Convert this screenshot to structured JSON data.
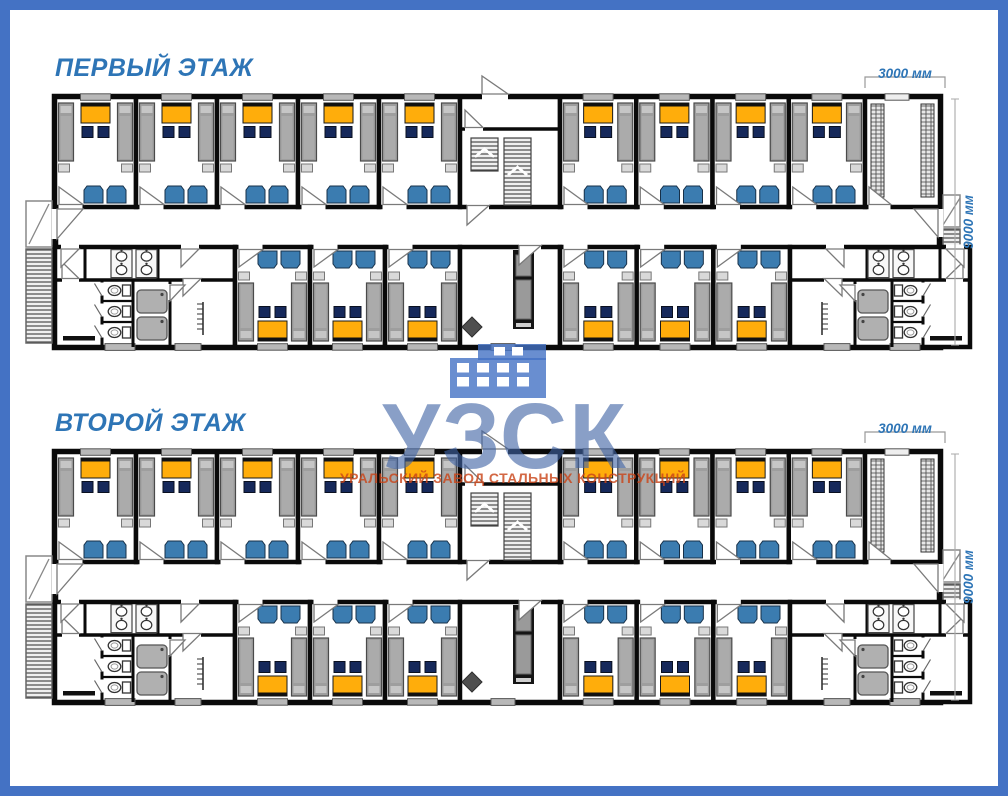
{
  "page": {
    "background": "#FFFFFF",
    "border_color": "#4472C4"
  },
  "floors": [
    {
      "title": "ПЕРВЫЙ ЭТАЖ",
      "dim_module_width": "3000 мм",
      "dim_depth": "9000 мм"
    },
    {
      "title": "ВТОРОЙ ЭТАЖ",
      "dim_module_width": "3000 мм",
      "dim_depth": "9000 мм"
    }
  ],
  "watermark": {
    "logo_text": "УЗСК",
    "subtitle": "УРАЛЬСКИЙ ЗАВОД СТАЛЬНЫХ КОНСТРУКЦИЙ",
    "logo_color": "rgba(64,100,165,0.62)",
    "subtitle_color": "rgba(201,70,26,0.82)",
    "icon_color": "rgba(68,114,196,0.8)"
  },
  "plan": {
    "title_color": "#2E75B6",
    "dim_color": "#2E75B6",
    "colors": {
      "wall": "#0A0A0A",
      "bed": "#9E9E9E",
      "bed_trim": "#C6C6C6",
      "desk": "#FFAD0B",
      "chair": "#16295B",
      "wardrobe": "#3B7CB0",
      "window": "#B8B8B8",
      "shaft": "#151515",
      "stair_line": "#3A3A3A"
    },
    "layout": {
      "rooms_top_left": 5,
      "rooms_top_right": 4,
      "rooms_bottom_left": 3,
      "rooms_bottom_right": 3,
      "beds_per_room": 2,
      "desks_per_room": 1,
      "chairs_per_room": 2,
      "wardrobes_per_room": 2,
      "wc_stalls_per_sanitary_block": 3,
      "showers_per_sanitary_block": 2,
      "sinks_per_sanitary_block": 4,
      "sanitary_blocks_per_floor": 2,
      "stairwells_per_floor": 1
    }
  }
}
